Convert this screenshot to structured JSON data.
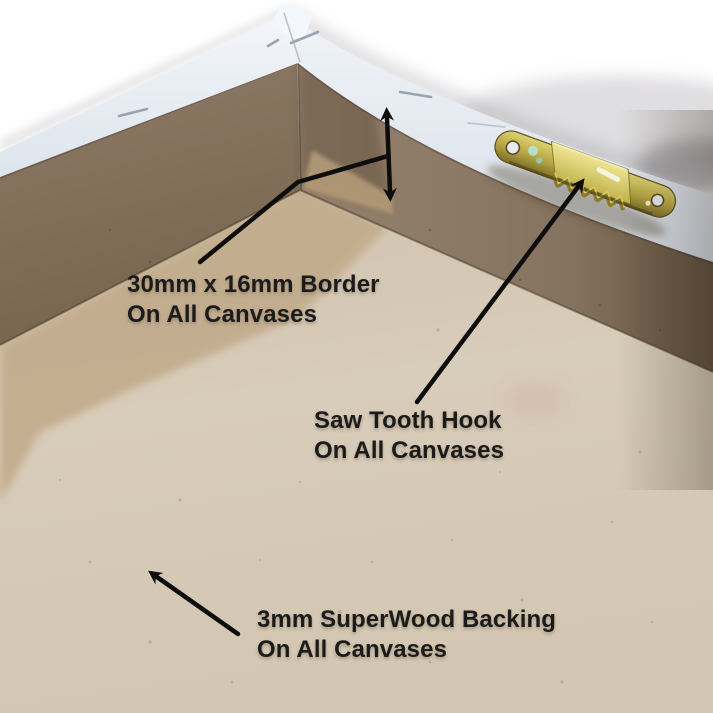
{
  "annotations": {
    "border": {
      "line1": "30mm x 16mm Border",
      "line2": "On All Canvases"
    },
    "saw_tooth_hook": {
      "line1": "Saw Tooth Hook",
      "line2": "On All Canvases"
    },
    "backing": {
      "line1": "3mm SuperWood Backing",
      "line2": "On All Canvases"
    }
  },
  "colors": {
    "background_white": "#ffffff",
    "canvas_edge_white": "#e9eef4",
    "mdf_border_brown": "#87735f",
    "backing_tan": "#d6c9b6",
    "stain_tan": "#c2ab8c",
    "hook_brass": "#b4a544",
    "arrow_black": "#0d0d0d",
    "text_black": "#1b1b1b"
  }
}
